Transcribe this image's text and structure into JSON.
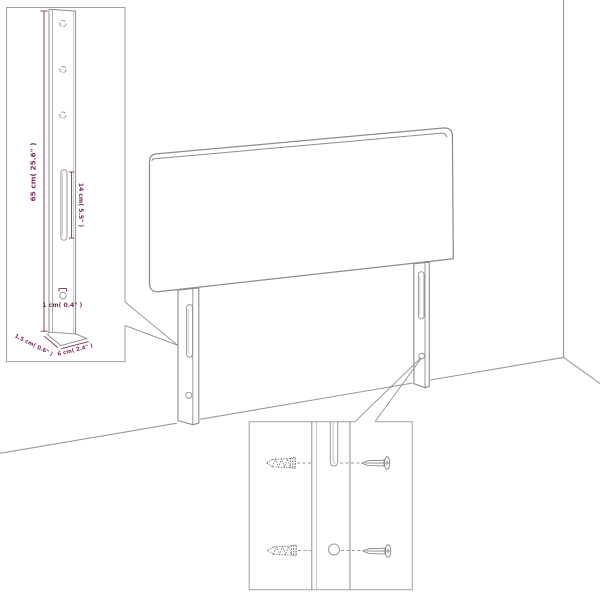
{
  "diagram": {
    "type": "furniture-assembly-diagram",
    "subject": "Headboard with two slotted legs, leg dimension detail inset and screw mounting detail inset"
  },
  "colors": {
    "background": "#ffffff",
    "outline_gray": "#8c8c8c",
    "floor_gray": "#9a9a9a",
    "inset_border_gray": "#a2a2a2",
    "dimension_purple": "#7d2e60"
  },
  "leg_detail_inset": {
    "height_label": "65 cm( 25.6\" )",
    "slot_label": "14 cm( 5.5\" )",
    "hole_label": "1 cm( 0.4\" )",
    "depth_label": "1.5 cm( 0.6\" )",
    "width_label": "6 cm( 2.4\" )"
  }
}
